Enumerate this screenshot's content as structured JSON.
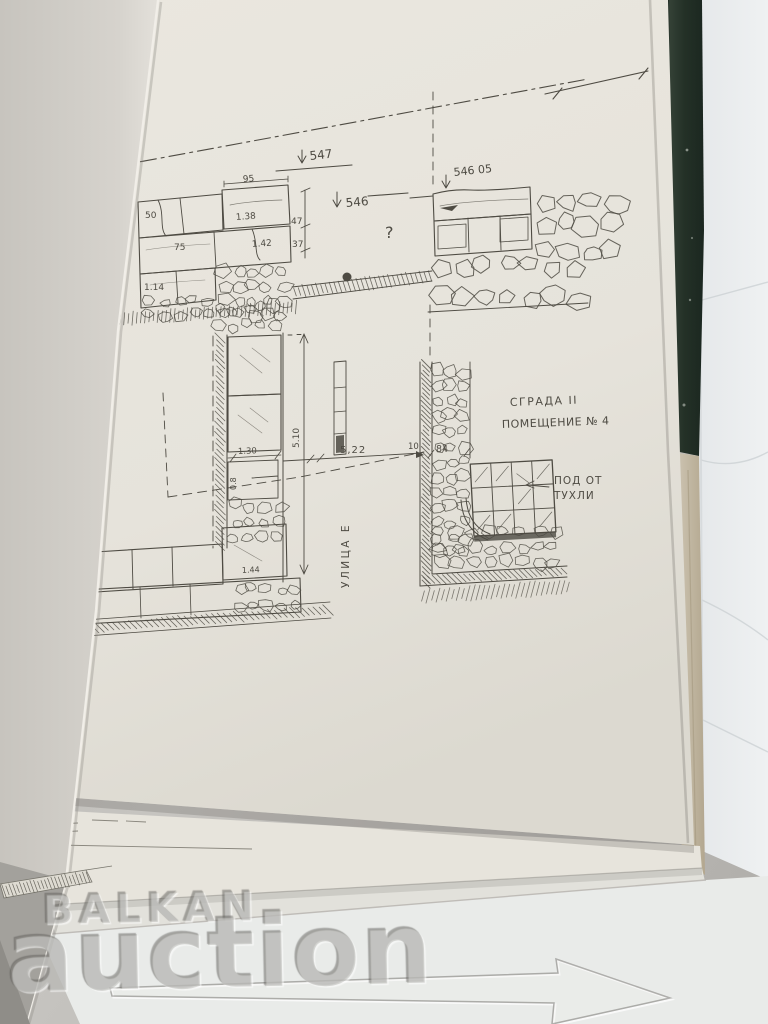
{
  "watermark": {
    "brand_top": "BALKAN",
    "brand_bottom": "auction"
  },
  "drawing": {
    "section": {
      "elev_main": "547",
      "elev_secondary": "546",
      "elev_right": "546 05",
      "unknown_mark": "?",
      "dim_top_width": "95",
      "dim_left_block": "50",
      "dim_block_a": "1.38",
      "dim_right_a": "47",
      "dim_right_b": "37",
      "dim_block_b": "1.42",
      "dim_block_c": "75",
      "dim_block_d": "1.14"
    },
    "plan": {
      "label_building": "СГРАДА II",
      "label_room": "ПОМЕЩЕНИЕ № 4",
      "label_floor_line1": "ПОД ОТ",
      "label_floor_line2": "ТУХЛИ",
      "label_street": "УЛИЦА Е",
      "dim_span": "5,22",
      "dim_gap": "10",
      "dim_wall": "84",
      "dim_block": "1.30",
      "dim_height": "5.10",
      "dim_block_b": "1.44",
      "dim_block_c": "0.8"
    }
  },
  "colors": {
    "cover_green": "#243127",
    "page_cream": "#e8e5dd",
    "paper_blue": "#eaedef",
    "ink": "#4e4b43"
  }
}
